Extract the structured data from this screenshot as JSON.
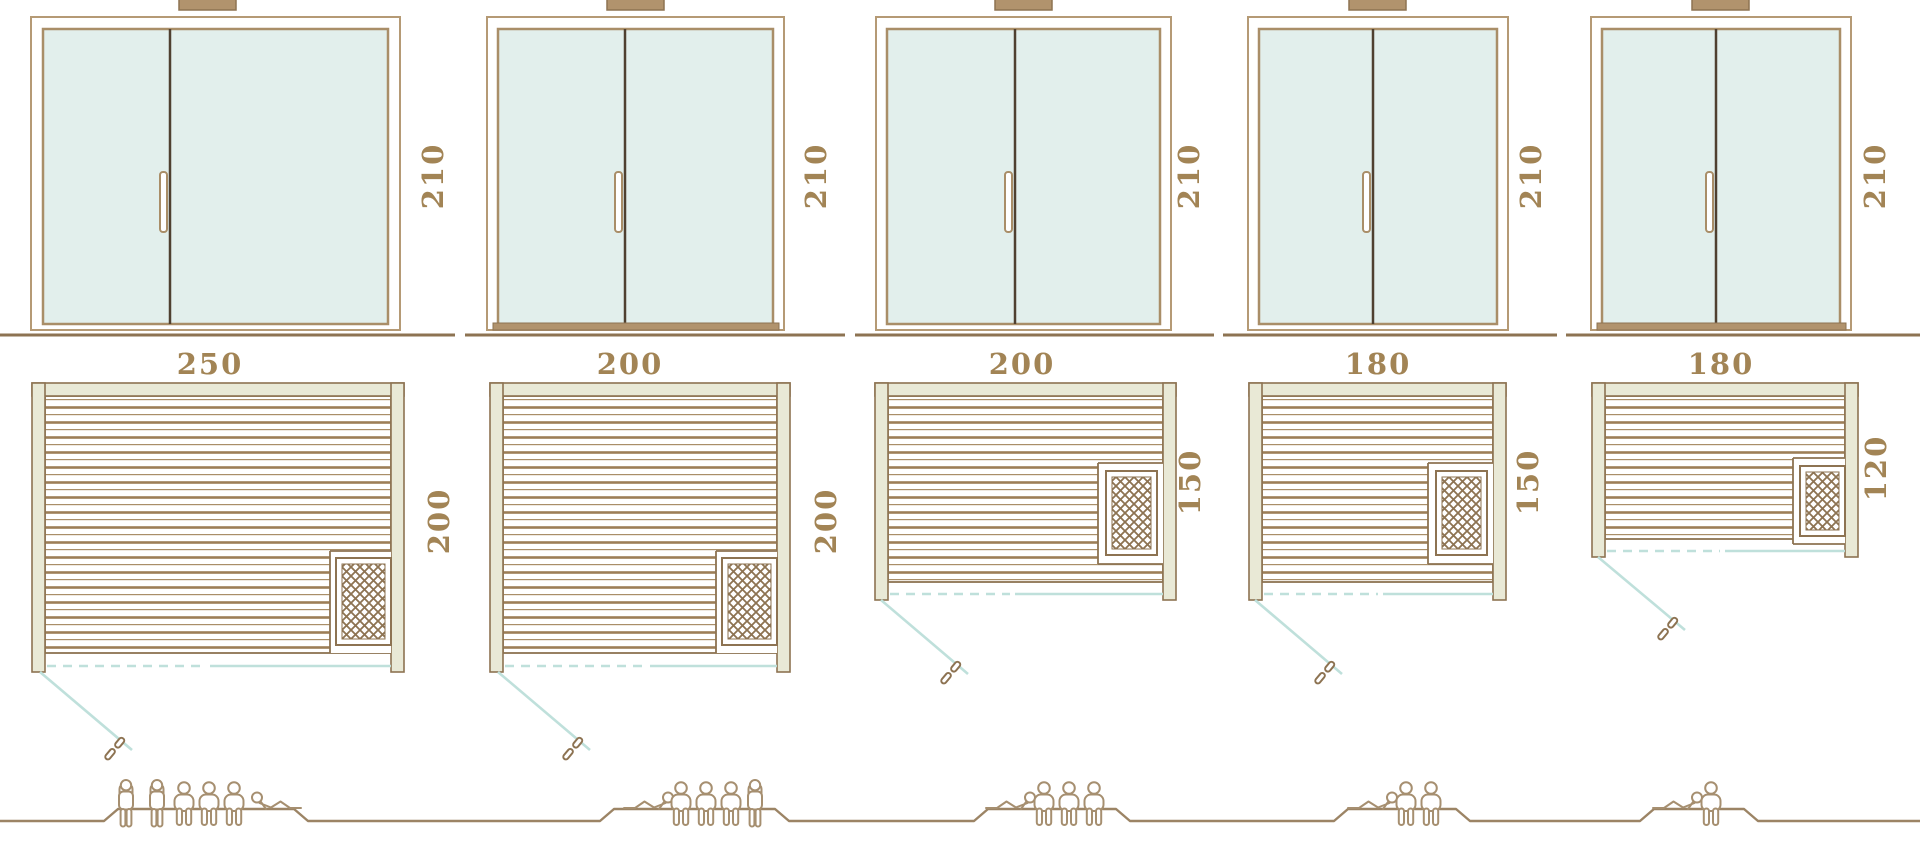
{
  "diagram": {
    "type": "sauna-size-comparison-drawing",
    "columns": 5,
    "rows": [
      "door-elevation",
      "floor-plan",
      "capacity-pictograms"
    ]
  },
  "saunas": [
    {
      "name": "sauna-250x200",
      "door_height": "210",
      "width": "250",
      "depth": "200",
      "capacity": {
        "total": 6,
        "standing": 2,
        "seated": 3,
        "lying": 1
      }
    },
    {
      "name": "sauna-200x200",
      "door_height": "210",
      "width": "200",
      "depth": "200",
      "capacity": {
        "total": 5,
        "standing": 1,
        "seated": 3,
        "lying": 1
      }
    },
    {
      "name": "sauna-200x150",
      "door_height": "210",
      "width": "200",
      "depth": "150",
      "capacity": {
        "total": 4,
        "standing": 0,
        "seated": 3,
        "lying": 1
      }
    },
    {
      "name": "sauna-180x150",
      "door_height": "210",
      "width": "180",
      "depth": "150",
      "capacity": {
        "total": 3,
        "standing": 0,
        "seated": 2,
        "lying": 1
      }
    },
    {
      "name": "sauna-180x120",
      "door_height": "210",
      "width": "180",
      "depth": "120",
      "capacity": {
        "total": 2,
        "standing": 0,
        "seated": 1,
        "lying": 1
      }
    }
  ],
  "colors": {
    "background": "#ffffff",
    "line_brown": "#8d7352",
    "frame_tan": "#b59a75",
    "plank_brown": "#9d7e57",
    "glass_mint": "#e2efec",
    "wall_beige": "#e9e9d6",
    "divider_dark": "#4f4030",
    "label_bronze": "#a28455",
    "door_swing_teal": "#bfe0db",
    "people_tan": "#a68f70",
    "chimney_tan": "#b1936d"
  }
}
